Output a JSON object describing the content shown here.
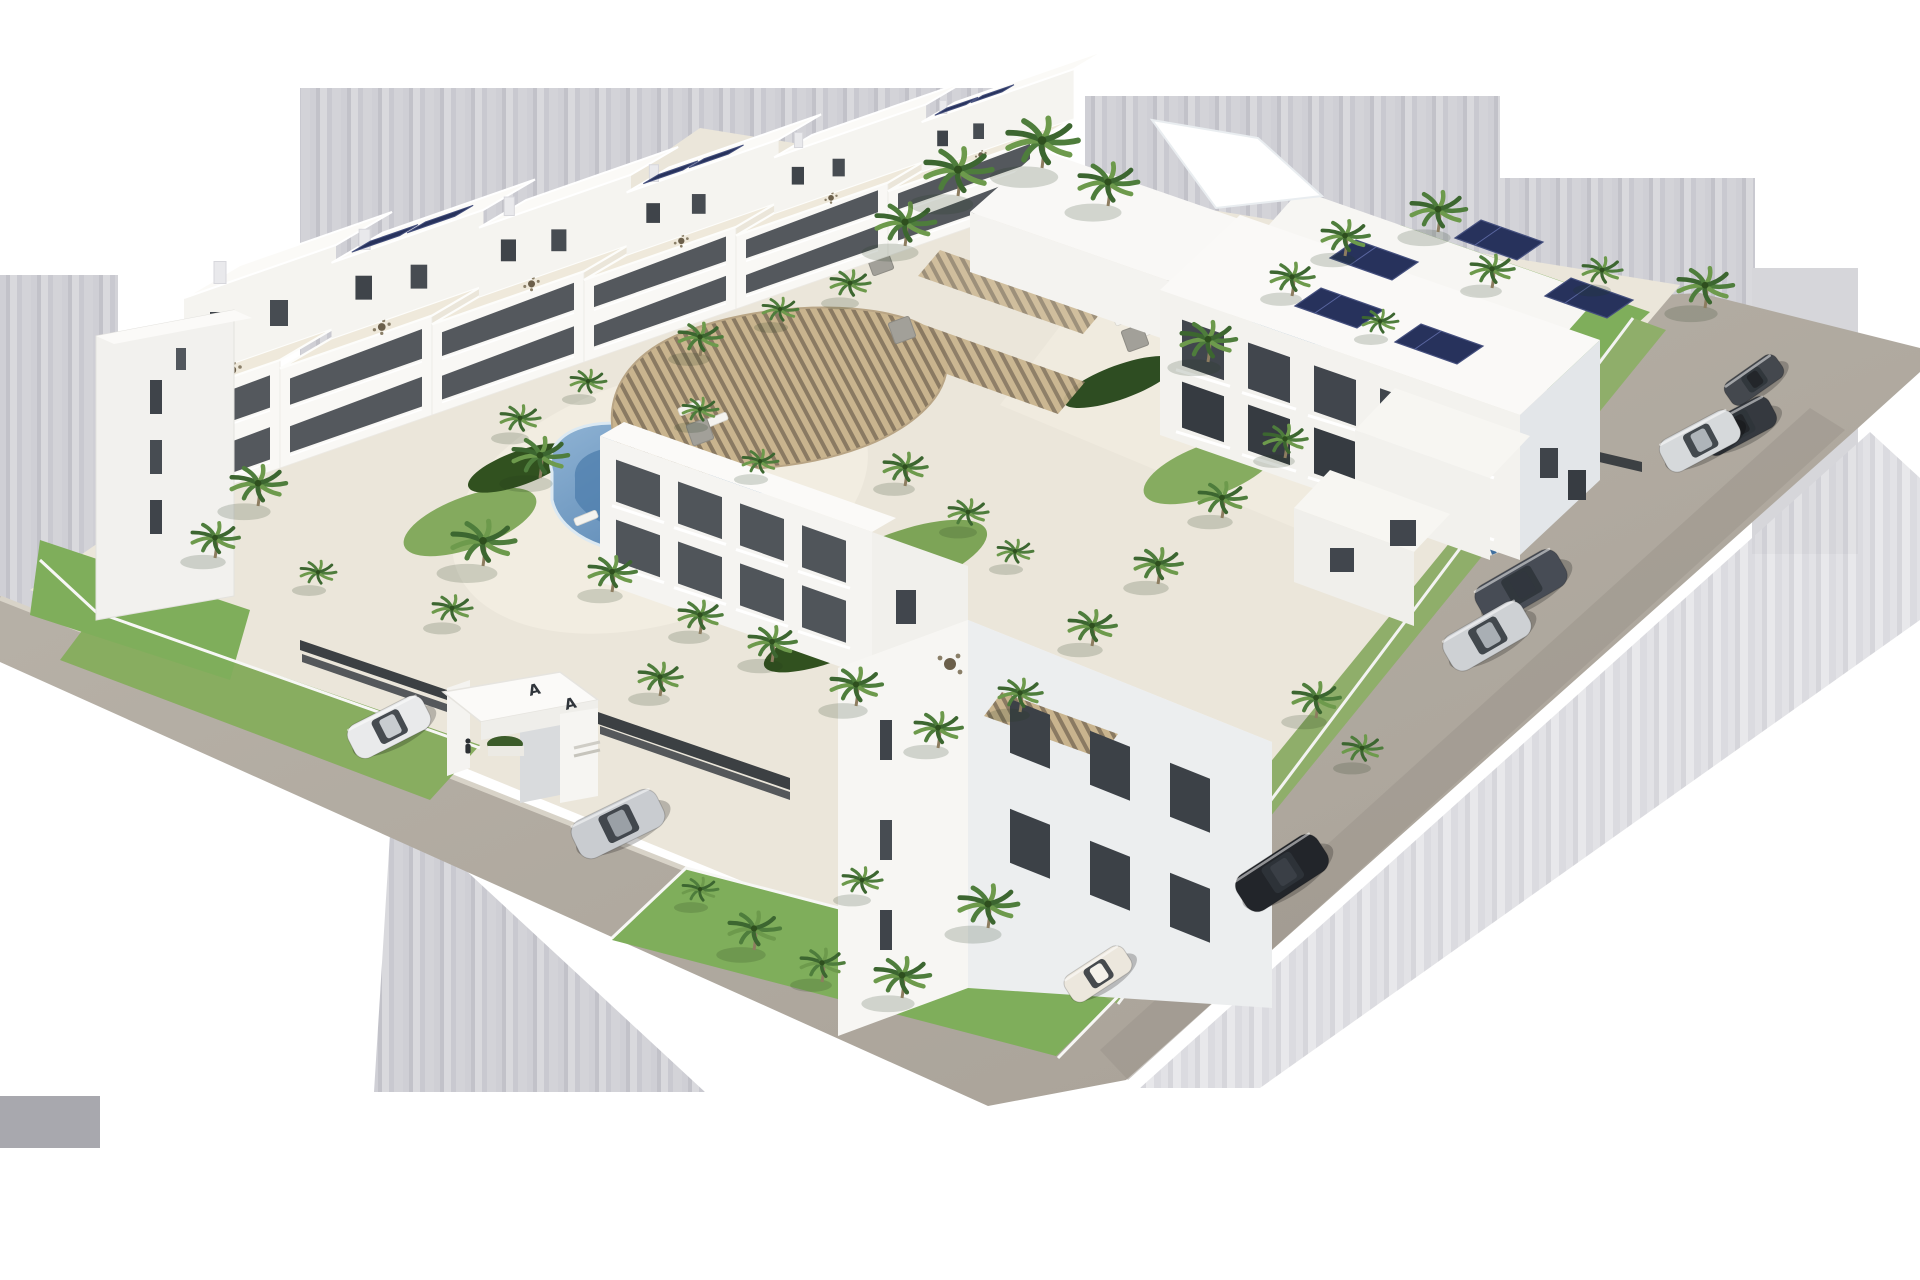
{
  "scene": {
    "type": "architectural-3d-render",
    "description": "Aerial 3D render of a white modern residential complex with landscaped courtyard, two swimming pools, wooden pergola, palm trees, perimeter roads and parked cars, isolated on a white background with gray smear bands",
    "background": "#ffffff"
  },
  "palette": {
    "bg": "#ffffff",
    "streak": "#cdcdd3",
    "solid_gray": "#a8a8ae",
    "road": "#b2aba1",
    "plate": "#ebe6da",
    "path": "#f2ede1",
    "deck": "#efe9db",
    "building_lit": "#f8f7f4",
    "building_face": "#f3f2ee",
    "building_shade": "#e3e6e9",
    "glass": "#41464d",
    "lawn": "#7fae5b",
    "lawn_dark": "#5c8a40",
    "shrub": "#31511f",
    "palm_green": "#4e7d3c",
    "palm_light": "#6d9a4c",
    "pool_deep": "#4e7dac",
    "pool_light": "#9fc3dc",
    "pool_rim": "#b5cede",
    "pergola_wood": "#c9b48e",
    "pergola_gap": "#8a7a62",
    "solar": "#27325c",
    "fence_dark": "#3c4043",
    "car_shadow": "rgba(0,0,0,0.22)"
  },
  "entrance": {
    "monogram_left": "A",
    "monogram_right": "A"
  },
  "pools": [
    {
      "name": "free-form pool",
      "shape": "kidney",
      "water": "#4e7dac"
    },
    {
      "name": "lap pool",
      "shape": "rectangular",
      "water": "#5b8ab6"
    }
  ],
  "counts": {
    "palm_trees": 47,
    "cars": 9,
    "pools": 2,
    "building_blocks": 3
  },
  "cars": [
    {
      "id": "dark-citycar",
      "color_name": "dark gray",
      "hex": "#44484e",
      "roof": "#23262a",
      "x": 1754,
      "y": 380,
      "angle": -35,
      "len": 62
    },
    {
      "id": "dark-suv",
      "color_name": "black",
      "hex": "#35393f",
      "roof": "#23262a",
      "x": 1738,
      "y": 426,
      "angle": -28,
      "len": 78
    },
    {
      "id": "silver-suv",
      "color_name": "silver",
      "hex": "#d6d9db",
      "roof": "#aeb4b9",
      "x": 1700,
      "y": 441,
      "angle": -28,
      "len": 82
    },
    {
      "id": "graphite-sedan",
      "color_name": "graphite",
      "hex": "#474c55",
      "roof": "#31363e",
      "x": 1521,
      "y": 586,
      "angle": -30,
      "len": 94
    },
    {
      "id": "silver-sedan-2",
      "color_name": "silver",
      "hex": "#ced1d4",
      "roof": "#a9afb4",
      "x": 1487,
      "y": 636,
      "angle": -30,
      "len": 90
    },
    {
      "id": "white-suv",
      "color_name": "white",
      "hex": "#e9eaeb",
      "roof": "#c8ccd0",
      "x": 389,
      "y": 727,
      "angle": -27,
      "len": 84
    },
    {
      "id": "silver-sedan",
      "color_name": "silver",
      "hex": "#c9ccd0",
      "roof": "#9aa0a6",
      "x": 618,
      "y": 824,
      "angle": -26,
      "len": 94
    },
    {
      "id": "black-sedan",
      "color_name": "black",
      "hex": "#22252a",
      "roof": "#3a3f46",
      "x": 1282,
      "y": 873,
      "angle": -33,
      "len": 96
    },
    {
      "id": "cream-hatchback",
      "color_name": "cream white",
      "hex": "#ece7dd",
      "roof": "#f4f1ea",
      "x": 1098,
      "y": 974,
      "angle": -33,
      "len": 70
    }
  ],
  "palms": [
    [
      215,
      552,
      24
    ],
    [
      258,
      500,
      28
    ],
    [
      318,
      583,
      18
    ],
    [
      452,
      620,
      20
    ],
    [
      483,
      560,
      32
    ],
    [
      660,
      690,
      22
    ],
    [
      520,
      430,
      20
    ],
    [
      588,
      392,
      18
    ],
    [
      700,
      350,
      22
    ],
    [
      780,
      320,
      18
    ],
    [
      850,
      295,
      20
    ],
    [
      905,
      240,
      30
    ],
    [
      958,
      190,
      34
    ],
    [
      1042,
      162,
      36
    ],
    [
      1108,
      200,
      30
    ],
    [
      540,
      472,
      28
    ],
    [
      612,
      586,
      24
    ],
    [
      700,
      628,
      22
    ],
    [
      772,
      656,
      24
    ],
    [
      856,
      700,
      26
    ],
    [
      938,
      742,
      24
    ],
    [
      1020,
      706,
      22
    ],
    [
      760,
      472,
      18
    ],
    [
      700,
      420,
      18
    ],
    [
      905,
      480,
      22
    ],
    [
      968,
      524,
      20
    ],
    [
      1015,
      562,
      18
    ],
    [
      1092,
      640,
      24
    ],
    [
      1158,
      578,
      24
    ],
    [
      1222,
      512,
      24
    ],
    [
      1285,
      452,
      22
    ],
    [
      1208,
      356,
      28
    ],
    [
      1292,
      290,
      22
    ],
    [
      1345,
      250,
      24
    ],
    [
      1438,
      226,
      28
    ],
    [
      1492,
      282,
      22
    ],
    [
      1380,
      332,
      18
    ],
    [
      1602,
      282,
      20
    ],
    [
      1705,
      302,
      28
    ],
    [
      1316,
      712,
      24
    ],
    [
      1362,
      760,
      20
    ],
    [
      754,
      944,
      26
    ],
    [
      822,
      976,
      22
    ],
    [
      902,
      992,
      28
    ],
    [
      988,
      922,
      30
    ],
    [
      862,
      892,
      20
    ],
    [
      700,
      900,
      18
    ]
  ]
}
